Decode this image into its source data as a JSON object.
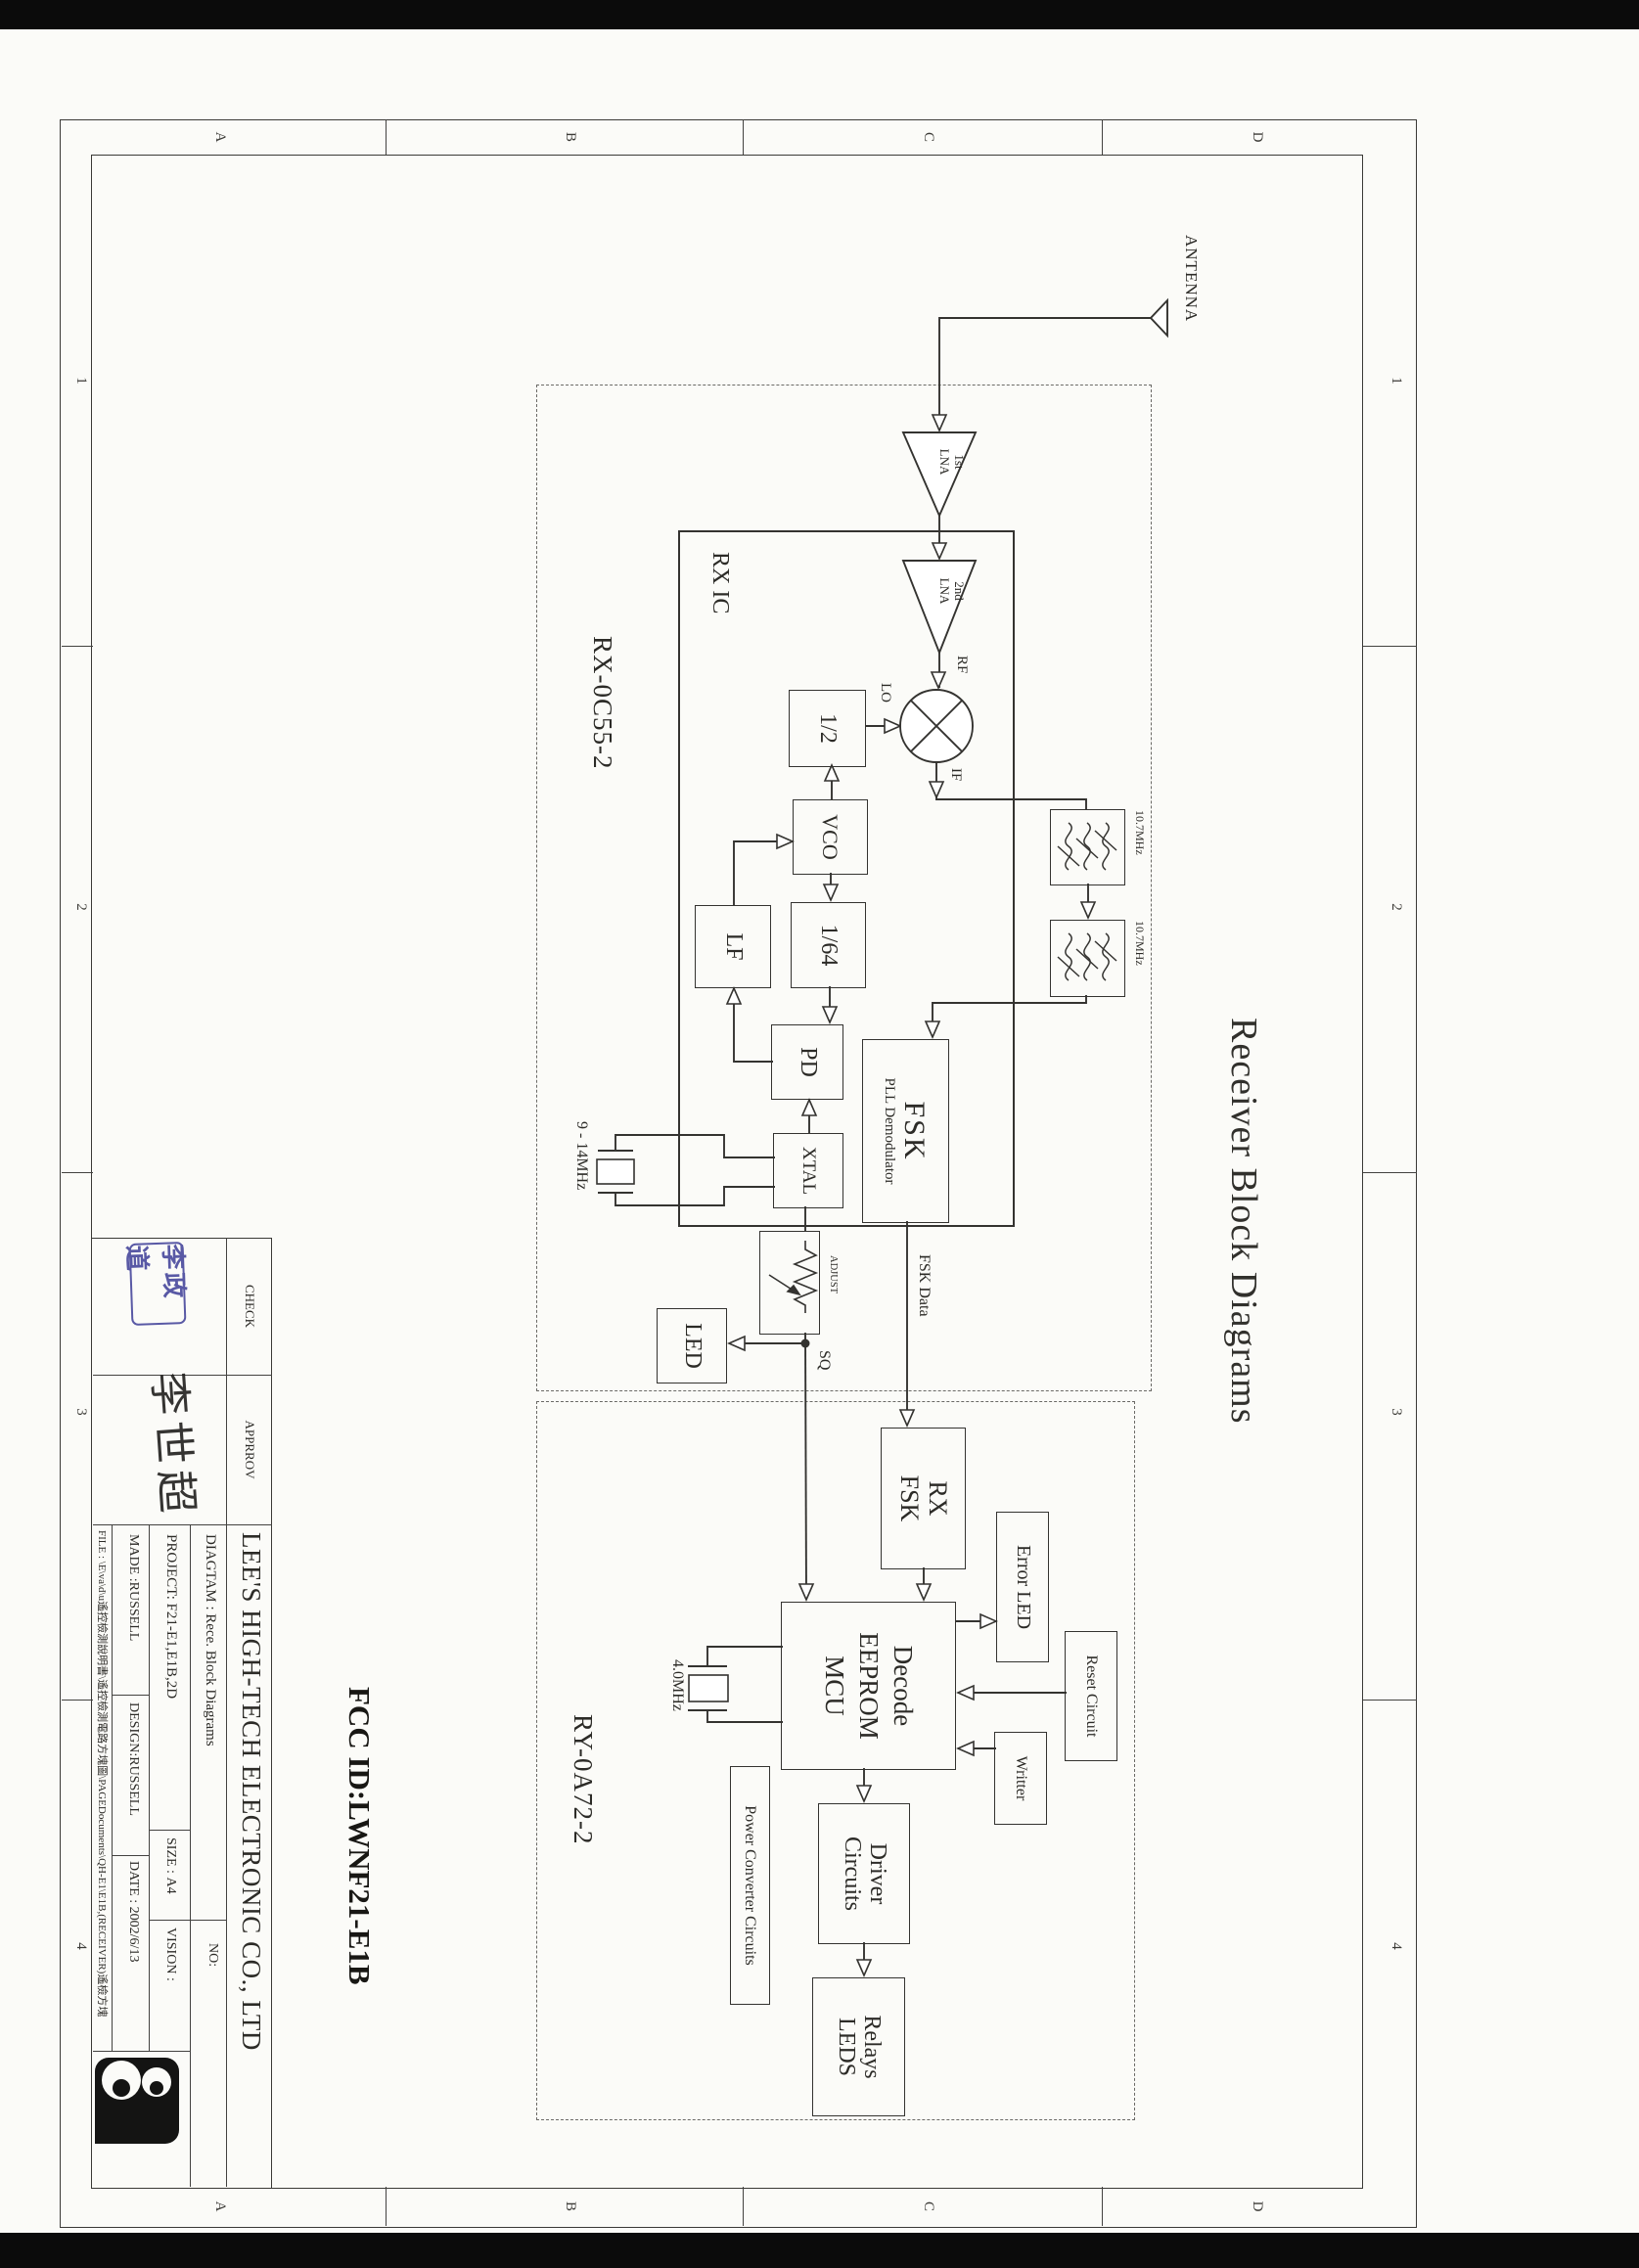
{
  "document": {
    "title": "Receiver Block Diagrams",
    "fcc_id": "FCC ID:LWNF21-E1B"
  },
  "frame": {
    "letters": [
      "D",
      "C",
      "B",
      "A"
    ],
    "numbers": [
      "1",
      "2",
      "3",
      "4"
    ]
  },
  "antenna": {
    "label": "ANTENNA"
  },
  "modules": {
    "rx": "RX-0C55-2",
    "decoder": "RY-0A72-2",
    "rx_ic": "RX IC"
  },
  "blocks": {
    "lna1": [
      "1st",
      "LNA"
    ],
    "lna2": [
      "2nd",
      "LNA"
    ],
    "half": "1/2",
    "vco": "VCO",
    "div64": "1/64",
    "pd": "PD",
    "lf": "LF",
    "xtal": "XTAL",
    "fsk": [
      "FSK",
      "PLL Demodulator"
    ],
    "led": "LED",
    "rx_fsk": [
      "RX",
      "FSK"
    ],
    "mcu": [
      "Decode",
      "EEPROM",
      "MCU"
    ],
    "error_led": "Error LED",
    "reset": "Reset Circuit",
    "writter": "Writter",
    "driver": [
      "Driver",
      "Circuits"
    ],
    "relays": [
      "Relays",
      "LEDS"
    ],
    "power": "Power Converter Circuits"
  },
  "wire_labels": {
    "rf": "RF",
    "lo": "LO",
    "if": "IF",
    "if_freq1": "10.7MHz",
    "if_freq2": "10.7MHz",
    "fsk_data": "FSK Data",
    "sq": "SQ",
    "adjust": "ADJUST",
    "xtal_range": "9 - 14MHz",
    "mcu_clock": "4.0MHz"
  },
  "title_block": {
    "company": "LEE'S HIGH-TECH ELECTRONIC CO., LTD",
    "check_label": "CHECK",
    "approve_label": "APPRROV",
    "check_stamp": "李政道",
    "approve_signature": "李世超",
    "diagram_label": "DIAGTAM :",
    "diagram_value": "Rece. Block Diagrams",
    "no_label": "NO:",
    "project_label": "PROJECT:",
    "project_value": "F21-E1,E1B,2D",
    "size_label": "SIZE :",
    "size_value": "A4",
    "vision_label": "VISION :",
    "made_label": "MADE :",
    "made_value": "RUSSELL",
    "design_label": "DESIGN:",
    "design_value": "RUSSELL",
    "date_label": "DATE :",
    "date_value": "2002/6/13",
    "file_line": "FILE : \\E\\va\\d\\u遙控檢測說明書\\遙控檢測電路方塊圖\\PAGEDocuments\\QH-E1\\E1B,(RECEIVER)遙檢方塊"
  }
}
